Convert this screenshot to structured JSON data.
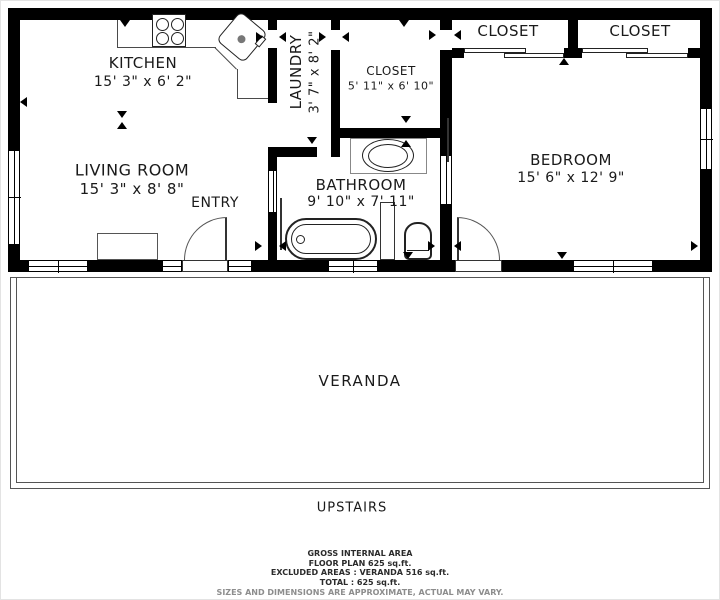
{
  "rooms": {
    "kitchen": {
      "name": "KITCHEN",
      "dims": "15' 3\" x 6' 2\""
    },
    "laundry": {
      "name": "LAUNDRY",
      "dims": "3' 7\" x 8' 2\""
    },
    "hall_closet": {
      "name": "CLOSET",
      "dims": "5' 11\" x 6' 10\""
    },
    "closet_left": {
      "name": "CLOSET"
    },
    "closet_right": {
      "name": "CLOSET"
    },
    "living_room": {
      "name": "LIVING ROOM",
      "dims": "15' 3\" x 8' 8\""
    },
    "entry": {
      "name": "ENTRY"
    },
    "bathroom": {
      "name": "BATHROOM",
      "dims": "9' 10\" x 7' 11\""
    },
    "bedroom": {
      "name": "BEDROOM",
      "dims": "15' 6\" x 12' 9\""
    },
    "veranda": {
      "name": "VERANDA"
    },
    "upstairs": {
      "name": "UPSTAIRS"
    }
  },
  "footer": {
    "area_title": "GROSS INTERNAL AREA",
    "floor_plan": "FLOOR PLAN 625 sq.ft.",
    "excluded": "EXCLUDED AREAS :  VERANDA 516 sq.ft.",
    "total": "TOTAL :  625 sq.ft.",
    "disclaimer": "SIZES AND DIMENSIONS ARE APPROXIMATE, ACTUAL MAY VARY."
  },
  "colors": {
    "wall": "#000000",
    "text": "#1a1a1a",
    "muted": "#8d8d8d",
    "outline": "#4a4a4a"
  }
}
